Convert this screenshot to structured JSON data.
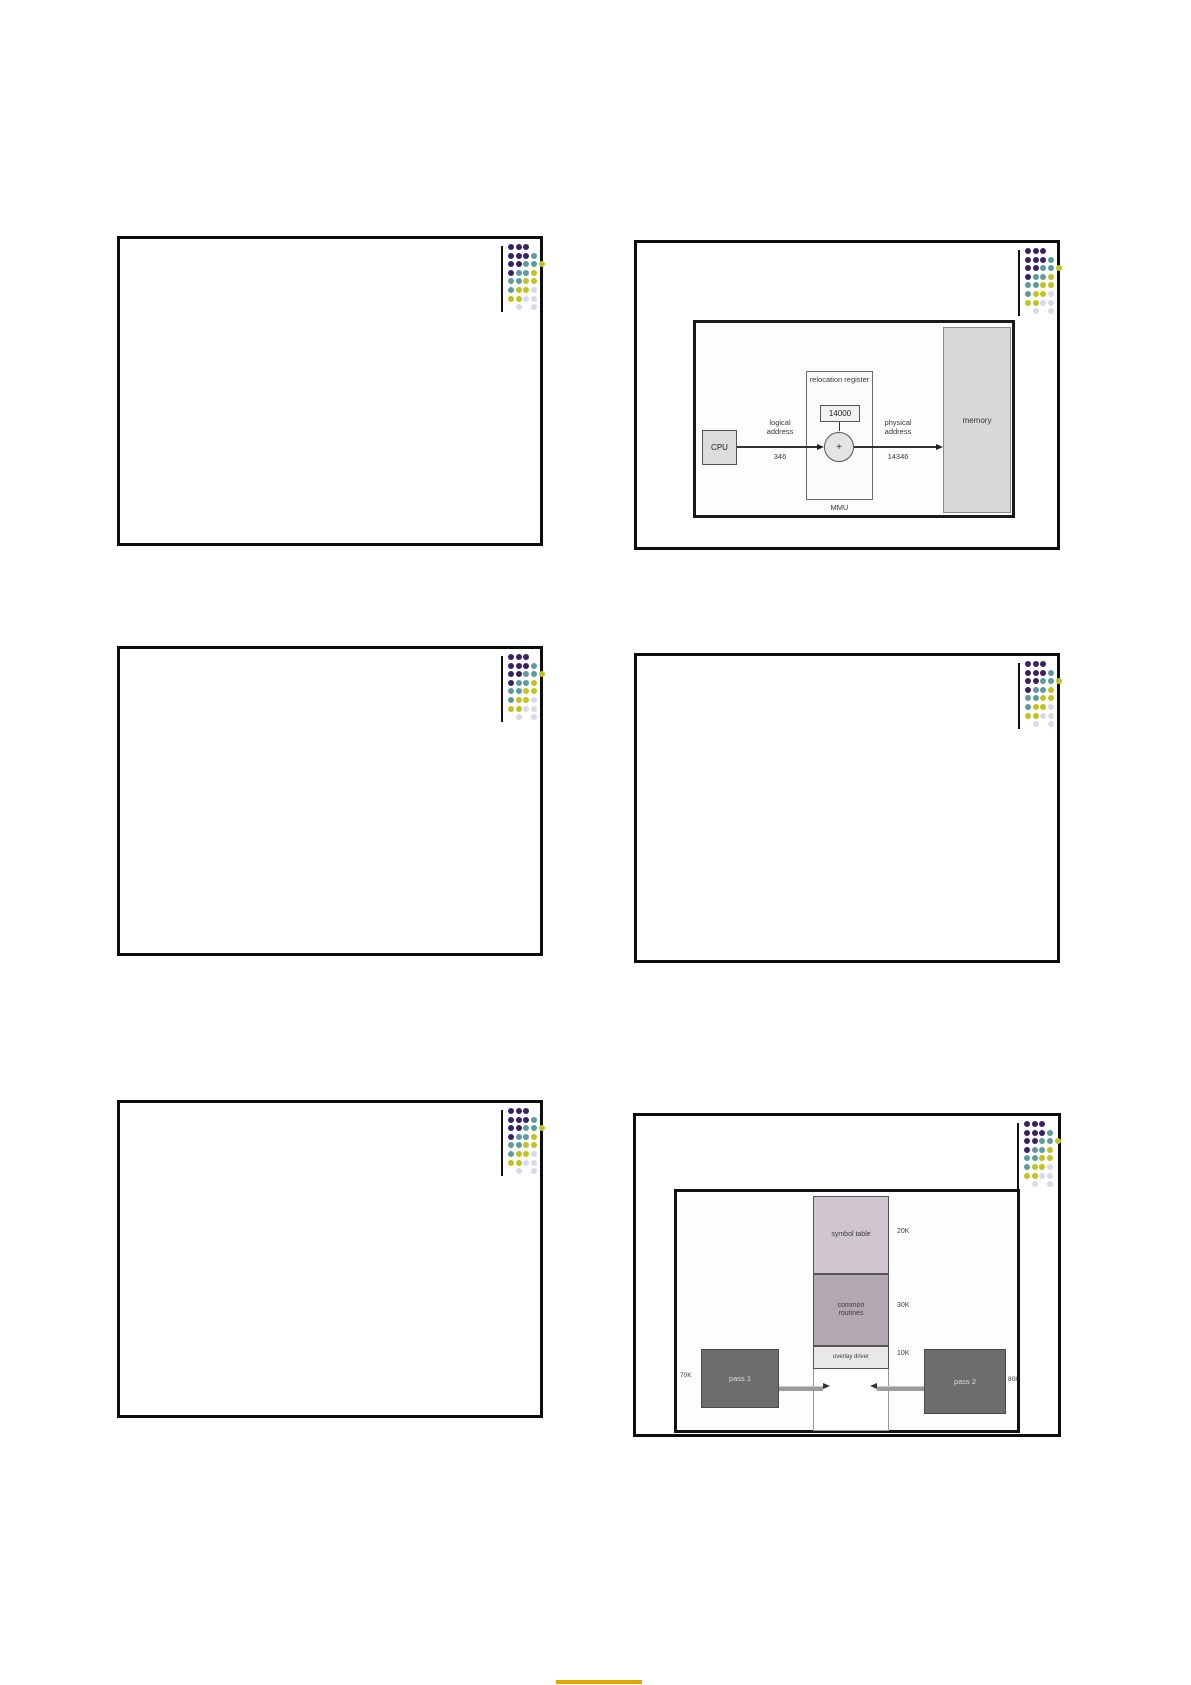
{
  "page": {
    "footer_mark_color": "#dfa700"
  },
  "logo": {
    "colors": {
      "P": "#3a2066",
      "T": "#5d9c9c",
      "Y": "#c2c220",
      "L": "#d9d9ec"
    },
    "pattern": [
      "PPP..",
      "PPPT.",
      "PPTTY",
      "PTTY.",
      "TTYY.",
      "TYYL.",
      "YYLL.",
      ".L.L."
    ]
  },
  "relocation_diagram": {
    "relocation_register_label": "relocation register",
    "relocation_register_value": "14000",
    "cpu_label": "CPU",
    "plus_label": "+",
    "mmu_label": "MMU",
    "memory_label": "memory",
    "logical_address_label": "logical address",
    "logical_address_value": "346",
    "physical_address_label": "physical address",
    "physical_address_value": "14346"
  },
  "overlay_diagram": {
    "symbol_table_label": "symbol table",
    "symbol_table_size": "20K",
    "common_routines_label": "common routines",
    "common_routines_size": "30K",
    "overlay_driver_label": "overlay driver",
    "overlay_driver_size": "10K",
    "pass1_label": "pass 1",
    "pass1_size": "70K",
    "pass2_label": "pass 2",
    "pass2_size": "80K"
  }
}
